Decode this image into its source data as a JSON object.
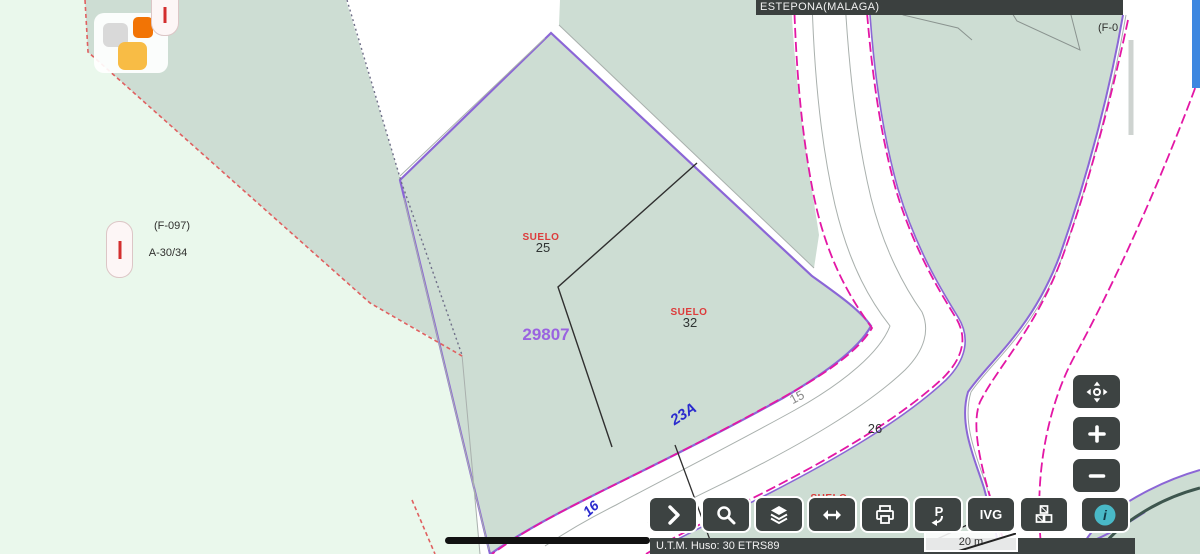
{
  "header": {
    "municipality": "ESTEPONA(MALAGA)"
  },
  "map": {
    "labels": {
      "ref_f097": "(F-097)",
      "code_a3034": "A-30/34",
      "suelo": "SUELO",
      "parcel25": "25",
      "parcel32": "32",
      "parcel26": "26",
      "parcel_ref": "29807",
      "road23a": "23A",
      "road15": "15",
      "road16": "16",
      "ref_f0_cut": "(F-0"
    },
    "colors": {
      "parcel_fill": "#cdddd3",
      "zone_pale_fill": "#eaf8ec",
      "road_magenta": "#e317a5",
      "boundary_purple": "#8b66d6",
      "parcel_ref_purple": "#9a63e0",
      "suelo_red": "#dd3b3b",
      "road_text_blue": "#2a2ace",
      "red_dashed": "#e06060",
      "ui_dark": "#3d4342",
      "info_teal": "#49b9c7",
      "scrollbar_blue": "#3d87e0"
    }
  },
  "toolbar": {
    "ivg_label": "IVG"
  },
  "statusbar": {
    "utm_label": "U.T.M. Huso: 30 ETRS89",
    "scale": "20 m"
  }
}
